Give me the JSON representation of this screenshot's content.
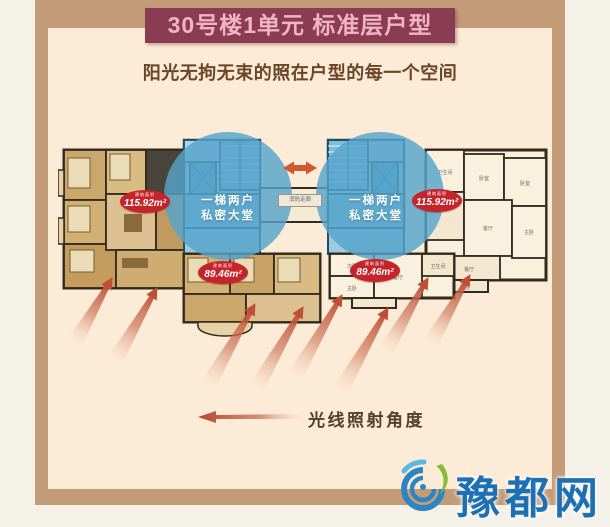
{
  "header": {
    "title": "30号楼1单元  标准层户型",
    "subtitle": "阳光无拘无束的照在户型的每一个空间"
  },
  "floorplan": {
    "area_prefix": "建筑面积",
    "units": [
      {
        "area": "115.92m²"
      },
      {
        "area": "115.92m²"
      },
      {
        "area": "89.46m²"
      },
      {
        "area": "89.46m²"
      }
    ],
    "lobby": {
      "line1": "一梯两户",
      "line2": "私密大堂"
    },
    "corridor_label": "消防走廊",
    "room_labels": [
      "卧室",
      "卧室",
      "卫生间",
      "客厅",
      "主卧",
      "餐厅",
      "阳台",
      "次卧",
      "主卧",
      "客厅",
      "卫生间"
    ]
  },
  "legend": {
    "label": "光线照射角度"
  },
  "watermark": {
    "text": "豫都网"
  },
  "colors": {
    "frame": "#C49B77",
    "inner_bg": "#FCEBD6",
    "banner_bg": "#8A3D52",
    "banner_text": "#F2B3C6",
    "highlight_circle": "#55A3CB",
    "area_badge": "#C6242B",
    "light_beam": "#BE4F35",
    "watermark_blue": "#1D70B4",
    "watermark_green": "#85BC3D"
  }
}
